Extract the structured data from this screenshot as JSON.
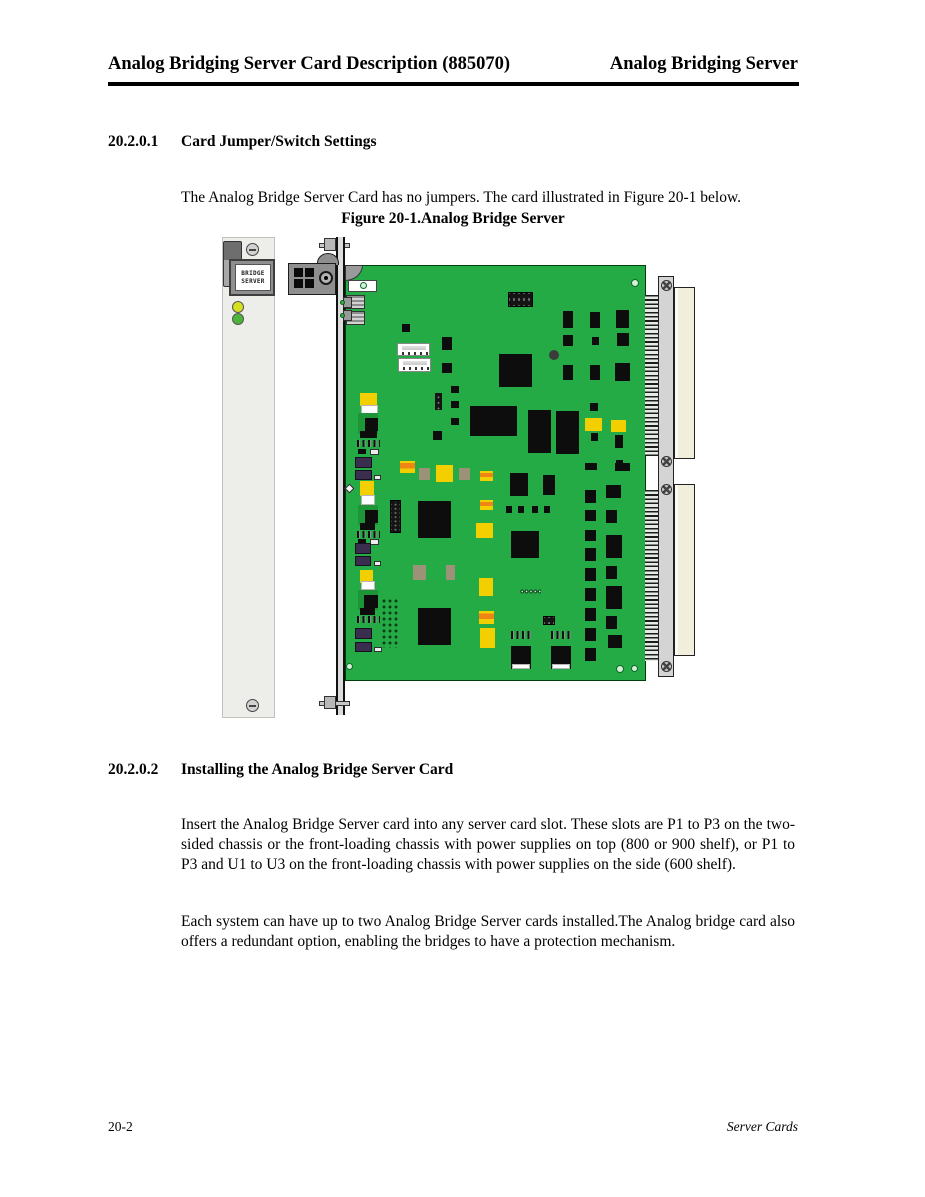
{
  "page": {
    "header_left": "Analog Bridging Server Card Description (885070)",
    "header_right": "Analog Bridging Server",
    "footer_left": "20-2",
    "footer_right": "Server Cards"
  },
  "sections": [
    {
      "number": "20.2.0.1",
      "title": "Card Jumper/Switch Settings",
      "paragraphs": [
        "The Analog Bridge Server Card has no jumpers. The card illustrated in Figure 20-1 below."
      ]
    },
    {
      "number": "20.2.0.2",
      "title": "Installing the Analog Bridge Server Card",
      "paragraphs": [
        "Insert the Analog Bridge Server card into any server card slot. These slots are P1 to P3 on the two-sided chassis or the front-loading chassis with power supplies on top (800 or 900 shelf), or P1 to P3 and U1 to U3 on the front-loading chassis with power supplies on the side (600 shelf).",
        "Each system can have up to two Analog Bridge Server cards installed.The Analog bridge card also offers a redundant option, enabling the bridges to have a protection mechanism."
      ]
    }
  ],
  "figure": {
    "caption": "Figure 20-1.Analog Bridge Server",
    "panel": {
      "label_line1": "BRIDGE",
      "label_line2": "SERVER"
    },
    "palette": {
      "pcb_green": "#24ab46",
      "pcb_dark": "#1d9638",
      "component_black": "#0d0d0d",
      "yellow": "#f3cf00",
      "orange": "#ef8514",
      "tan": "#9c9277",
      "purple": "#3a2d4e",
      "beige": "#f1eedb",
      "panel_gray": "#ededea",
      "rail_gray": "#d4d4d4",
      "metal_gray": "#8f8f8f",
      "led_yellow": "#d6e021",
      "led_green": "#4db43a"
    },
    "components": [
      {
        "cls": "corner",
        "x": 123,
        "y": 28,
        "w": 18,
        "h": 16
      },
      {
        "cls": "wbox",
        "x": 126,
        "y": 43,
        "w": 29,
        "h": 12
      },
      {
        "cls": "ring",
        "x": 138,
        "y": 45,
        "w": 7,
        "h": 7
      },
      {
        "cls": "comb",
        "x": 124,
        "y": 58,
        "w": 19,
        "h": 14
      },
      {
        "cls": "comb",
        "x": 124,
        "y": 74,
        "w": 19,
        "h": 14
      },
      {
        "cls": "gray",
        "x": 121,
        "y": 60,
        "w": 9,
        "h": 11
      },
      {
        "cls": "gray",
        "x": 121,
        "y": 73,
        "w": 9,
        "h": 11
      },
      {
        "cls": "grn-dot",
        "x": 118,
        "y": 63,
        "w": 5,
        "h": 5
      },
      {
        "cls": "grn-dot",
        "x": 118,
        "y": 76,
        "w": 5,
        "h": 5
      },
      {
        "cls": "hdr",
        "x": 286,
        "y": 55,
        "w": 25,
        "h": 15
      },
      {
        "cls": "ic",
        "x": 180,
        "y": 87,
        "w": 8,
        "h": 8
      },
      {
        "cls": "wconn",
        "x": 175,
        "y": 106,
        "w": 33,
        "h": 13
      },
      {
        "cls": "wconn",
        "x": 176,
        "y": 121,
        "w": 33,
        "h": 14
      },
      {
        "cls": "ic",
        "x": 220,
        "y": 100,
        "w": 10,
        "h": 13
      },
      {
        "cls": "ic",
        "x": 220,
        "y": 126,
        "w": 10,
        "h": 10
      },
      {
        "cls": "ic",
        "x": 277,
        "y": 117,
        "w": 33,
        "h": 33
      },
      {
        "cls": "hole",
        "x": 327,
        "y": 113,
        "w": 10,
        "h": 10
      },
      {
        "cls": "ring",
        "x": 409,
        "y": 42,
        "w": 8,
        "h": 8
      },
      {
        "cls": "ic",
        "x": 341,
        "y": 74,
        "w": 10,
        "h": 17
      },
      {
        "cls": "ic",
        "x": 368,
        "y": 75,
        "w": 10,
        "h": 16
      },
      {
        "cls": "ic",
        "x": 394,
        "y": 73,
        "w": 13,
        "h": 18
      },
      {
        "cls": "ic",
        "x": 341,
        "y": 98,
        "w": 10,
        "h": 11
      },
      {
        "cls": "ic",
        "x": 370,
        "y": 100,
        "w": 7,
        "h": 8
      },
      {
        "cls": "ic",
        "x": 395,
        "y": 96,
        "w": 12,
        "h": 13
      },
      {
        "cls": "ic",
        "x": 341,
        "y": 128,
        "w": 10,
        "h": 15
      },
      {
        "cls": "ic",
        "x": 368,
        "y": 128,
        "w": 10,
        "h": 15
      },
      {
        "cls": "ic",
        "x": 393,
        "y": 126,
        "w": 15,
        "h": 18
      },
      {
        "cls": "yel",
        "x": 138,
        "y": 156,
        "w": 17,
        "h": 13
      },
      {
        "cls": "wht",
        "x": 139,
        "y": 168,
        "w": 17,
        "h": 10
      },
      {
        "cls": "clusbg",
        "x": 136,
        "y": 176,
        "w": 20,
        "h": 21
      },
      {
        "cls": "ic",
        "x": 143,
        "y": 181,
        "w": 13,
        "h": 13
      },
      {
        "cls": "ic",
        "x": 138,
        "y": 194,
        "w": 17,
        "h": 7
      },
      {
        "cls": "pads",
        "x": 135,
        "y": 203,
        "w": 23,
        "h": 7
      },
      {
        "cls": "ic",
        "x": 136,
        "y": 212,
        "w": 8,
        "h": 5
      },
      {
        "cls": "wpad",
        "x": 148,
        "y": 212,
        "w": 9,
        "h": 6
      },
      {
        "cls": "vhdr",
        "x": 213,
        "y": 156,
        "w": 7,
        "h": 17
      },
      {
        "cls": "ic",
        "x": 229,
        "y": 149,
        "w": 8,
        "h": 7
      },
      {
        "cls": "ic",
        "x": 229,
        "y": 164,
        "w": 8,
        "h": 7
      },
      {
        "cls": "ic",
        "x": 229,
        "y": 181,
        "w": 8,
        "h": 7
      },
      {
        "cls": "ic",
        "x": 248,
        "y": 169,
        "w": 47,
        "h": 30
      },
      {
        "cls": "ic",
        "x": 306,
        "y": 173,
        "w": 23,
        "h": 43
      },
      {
        "cls": "ic",
        "x": 334,
        "y": 174,
        "w": 23,
        "h": 43
      },
      {
        "cls": "ic",
        "x": 211,
        "y": 194,
        "w": 9,
        "h": 9
      },
      {
        "cls": "ic",
        "x": 368,
        "y": 166,
        "w": 8,
        "h": 8
      },
      {
        "cls": "yel",
        "x": 363,
        "y": 181,
        "w": 17,
        "h": 13
      },
      {
        "cls": "yel",
        "x": 389,
        "y": 183,
        "w": 15,
        "h": 12
      },
      {
        "cls": "ic",
        "x": 369,
        "y": 196,
        "w": 7,
        "h": 8
      },
      {
        "cls": "ic",
        "x": 393,
        "y": 198,
        "w": 8,
        "h": 13
      },
      {
        "cls": "ic",
        "x": 394,
        "y": 223,
        "w": 7,
        "h": 7
      },
      {
        "cls": "ic",
        "x": 363,
        "y": 226,
        "w": 12,
        "h": 7
      },
      {
        "cls": "ic",
        "x": 393,
        "y": 226,
        "w": 15,
        "h": 8
      },
      {
        "cls": "pur",
        "x": 133,
        "y": 220,
        "w": 17,
        "h": 11
      },
      {
        "cls": "pur",
        "x": 133,
        "y": 233,
        "w": 17,
        "h": 10
      },
      {
        "cls": "wpad",
        "x": 152,
        "y": 238,
        "w": 7,
        "h": 5
      },
      {
        "cls": "ocap",
        "x": 178,
        "y": 224,
        "w": 15,
        "h": 12
      },
      {
        "cls": "tan",
        "x": 197,
        "y": 231,
        "w": 11,
        "h": 12
      },
      {
        "cls": "yel",
        "x": 214,
        "y": 228,
        "w": 17,
        "h": 17
      },
      {
        "cls": "tan",
        "x": 237,
        "y": 231,
        "w": 11,
        "h": 12
      },
      {
        "cls": "ocap",
        "x": 258,
        "y": 234,
        "w": 13,
        "h": 10
      },
      {
        "cls": "ic",
        "x": 288,
        "y": 236,
        "w": 18,
        "h": 23
      },
      {
        "cls": "ic",
        "x": 321,
        "y": 238,
        "w": 12,
        "h": 20
      },
      {
        "cls": "dia",
        "x": 124,
        "y": 248,
        "w": 7,
        "h": 7
      },
      {
        "cls": "yel",
        "x": 138,
        "y": 244,
        "w": 14,
        "h": 15
      },
      {
        "cls": "wht",
        "x": 139,
        "y": 258,
        "w": 14,
        "h": 10
      },
      {
        "cls": "clusbg",
        "x": 136,
        "y": 268,
        "w": 20,
        "h": 20
      },
      {
        "cls": "ic",
        "x": 143,
        "y": 273,
        "w": 13,
        "h": 13
      },
      {
        "cls": "ic",
        "x": 138,
        "y": 286,
        "w": 15,
        "h": 7
      },
      {
        "cls": "pads",
        "x": 135,
        "y": 294,
        "w": 23,
        "h": 7
      },
      {
        "cls": "ic",
        "x": 136,
        "y": 302,
        "w": 8,
        "h": 5
      },
      {
        "cls": "wpad",
        "x": 148,
        "y": 302,
        "w": 9,
        "h": 6
      },
      {
        "cls": "hdr2",
        "x": 168,
        "y": 263,
        "w": 11,
        "h": 33
      },
      {
        "cls": "ic",
        "x": 196,
        "y": 264,
        "w": 33,
        "h": 37
      },
      {
        "cls": "ocap",
        "x": 258,
        "y": 263,
        "w": 13,
        "h": 10
      },
      {
        "cls": "ic",
        "x": 284,
        "y": 269,
        "w": 6,
        "h": 7
      },
      {
        "cls": "ic",
        "x": 296,
        "y": 269,
        "w": 6,
        "h": 7
      },
      {
        "cls": "ic",
        "x": 310,
        "y": 269,
        "w": 6,
        "h": 7
      },
      {
        "cls": "ic",
        "x": 322,
        "y": 269,
        "w": 6,
        "h": 7
      },
      {
        "cls": "yel",
        "x": 254,
        "y": 286,
        "w": 17,
        "h": 15
      },
      {
        "cls": "ic",
        "x": 289,
        "y": 294,
        "w": 28,
        "h": 27
      },
      {
        "cls": "pur",
        "x": 133,
        "y": 306,
        "w": 16,
        "h": 11
      },
      {
        "cls": "pur",
        "x": 133,
        "y": 319,
        "w": 16,
        "h": 10
      },
      {
        "cls": "wpad",
        "x": 152,
        "y": 324,
        "w": 7,
        "h": 5
      },
      {
        "cls": "yel",
        "x": 138,
        "y": 333,
        "w": 13,
        "h": 13
      },
      {
        "cls": "wht",
        "x": 139,
        "y": 344,
        "w": 14,
        "h": 9
      },
      {
        "cls": "clusbg",
        "x": 136,
        "y": 353,
        "w": 20,
        "h": 20
      },
      {
        "cls": "ic",
        "x": 142,
        "y": 358,
        "w": 14,
        "h": 13
      },
      {
        "cls": "ic",
        "x": 138,
        "y": 371,
        "w": 15,
        "h": 7
      },
      {
        "cls": "pads",
        "x": 135,
        "y": 379,
        "w": 23,
        "h": 7
      },
      {
        "cls": "vias",
        "x": 159,
        "y": 361,
        "w": 18,
        "h": 50
      },
      {
        "cls": "tan",
        "x": 191,
        "y": 328,
        "w": 13,
        "h": 15
      },
      {
        "cls": "tan",
        "x": 224,
        "y": 328,
        "w": 9,
        "h": 15
      },
      {
        "cls": "ic",
        "x": 196,
        "y": 371,
        "w": 33,
        "h": 37
      },
      {
        "cls": "yel",
        "x": 257,
        "y": 341,
        "w": 14,
        "h": 18
      },
      {
        "cls": "ocap",
        "x": 257,
        "y": 374,
        "w": 15,
        "h": 13
      },
      {
        "cls": "yel",
        "x": 258,
        "y": 391,
        "w": 15,
        "h": 20
      },
      {
        "cls": "coil",
        "x": 298,
        "y": 351,
        "w": 21,
        "h": 7
      },
      {
        "cls": "hdr",
        "x": 321,
        "y": 379,
        "w": 12,
        "h": 9
      },
      {
        "cls": "pads",
        "x": 289,
        "y": 394,
        "w": 20,
        "h": 8
      },
      {
        "cls": "pads",
        "x": 329,
        "y": 394,
        "w": 20,
        "h": 8
      },
      {
        "cls": "ic",
        "x": 289,
        "y": 409,
        "w": 20,
        "h": 23
      },
      {
        "cls": "wht",
        "x": 290,
        "y": 427,
        "w": 18,
        "h": 5
      },
      {
        "cls": "ic",
        "x": 329,
        "y": 409,
        "w": 20,
        "h": 23
      },
      {
        "cls": "wht",
        "x": 330,
        "y": 427,
        "w": 18,
        "h": 5
      },
      {
        "cls": "pur",
        "x": 133,
        "y": 391,
        "w": 17,
        "h": 11
      },
      {
        "cls": "pur",
        "x": 133,
        "y": 405,
        "w": 17,
        "h": 10
      },
      {
        "cls": "wpad",
        "x": 152,
        "y": 410,
        "w": 8,
        "h": 5
      },
      {
        "cls": "ic",
        "x": 363,
        "y": 253,
        "w": 11,
        "h": 13
      },
      {
        "cls": "ic",
        "x": 363,
        "y": 273,
        "w": 11,
        "h": 11
      },
      {
        "cls": "ic",
        "x": 363,
        "y": 293,
        "w": 11,
        "h": 11
      },
      {
        "cls": "ic",
        "x": 363,
        "y": 311,
        "w": 11,
        "h": 13
      },
      {
        "cls": "ic",
        "x": 363,
        "y": 331,
        "w": 11,
        "h": 13
      },
      {
        "cls": "ic",
        "x": 363,
        "y": 351,
        "w": 11,
        "h": 13
      },
      {
        "cls": "ic",
        "x": 363,
        "y": 371,
        "w": 11,
        "h": 13
      },
      {
        "cls": "ic",
        "x": 363,
        "y": 391,
        "w": 11,
        "h": 13
      },
      {
        "cls": "ic",
        "x": 363,
        "y": 411,
        "w": 11,
        "h": 13
      },
      {
        "cls": "ic",
        "x": 384,
        "y": 248,
        "w": 15,
        "h": 13
      },
      {
        "cls": "ic",
        "x": 384,
        "y": 273,
        "w": 11,
        "h": 13
      },
      {
        "cls": "ic",
        "x": 384,
        "y": 298,
        "w": 16,
        "h": 23
      },
      {
        "cls": "ic",
        "x": 384,
        "y": 329,
        "w": 11,
        "h": 13
      },
      {
        "cls": "ic",
        "x": 384,
        "y": 349,
        "w": 16,
        "h": 23
      },
      {
        "cls": "ic",
        "x": 384,
        "y": 379,
        "w": 11,
        "h": 13
      },
      {
        "cls": "ic",
        "x": 386,
        "y": 398,
        "w": 14,
        "h": 13
      },
      {
        "cls": "ring",
        "x": 124,
        "y": 426,
        "w": 7,
        "h": 7
      },
      {
        "cls": "ring",
        "x": 394,
        "y": 428,
        "w": 8,
        "h": 8
      },
      {
        "cls": "ring",
        "x": 409,
        "y": 428,
        "w": 7,
        "h": 7
      }
    ]
  }
}
